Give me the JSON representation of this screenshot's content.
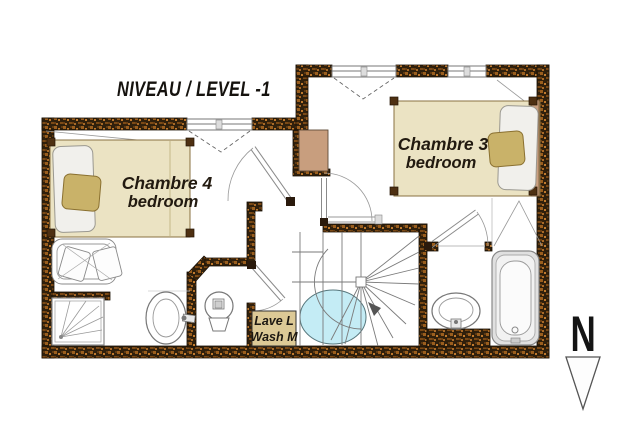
{
  "title": "NIVEAU / LEVEL -1",
  "rooms": {
    "chambre4": {
      "name": "Chambre 4",
      "subtitle": "bedroom"
    },
    "chambre3": {
      "name": "Chambre 3",
      "subtitle": "bedroom"
    },
    "laundry": {
      "line1": "Lave L",
      "line2": "Wash M"
    }
  },
  "compass": {
    "label": "N"
  },
  "fixtures": [
    "double-bed",
    "double-bed",
    "shower",
    "washbasin",
    "toilet",
    "winding-staircase",
    "washbasin",
    "bathtub",
    "washing-machine",
    "wardrobe",
    "duct-box",
    "door",
    "window"
  ],
  "colors": {
    "wall_dark": "#30200c",
    "wall_speck": "#a3651f",
    "floor": "#ffffff",
    "bed_fill": "#ebe3c3",
    "pillow_tan": "#c9b269",
    "duct_box": "#c89e7e",
    "laundry_box": "#dcc996",
    "stair_ellipse": "#c4ecf5",
    "text": "#221a10"
  }
}
